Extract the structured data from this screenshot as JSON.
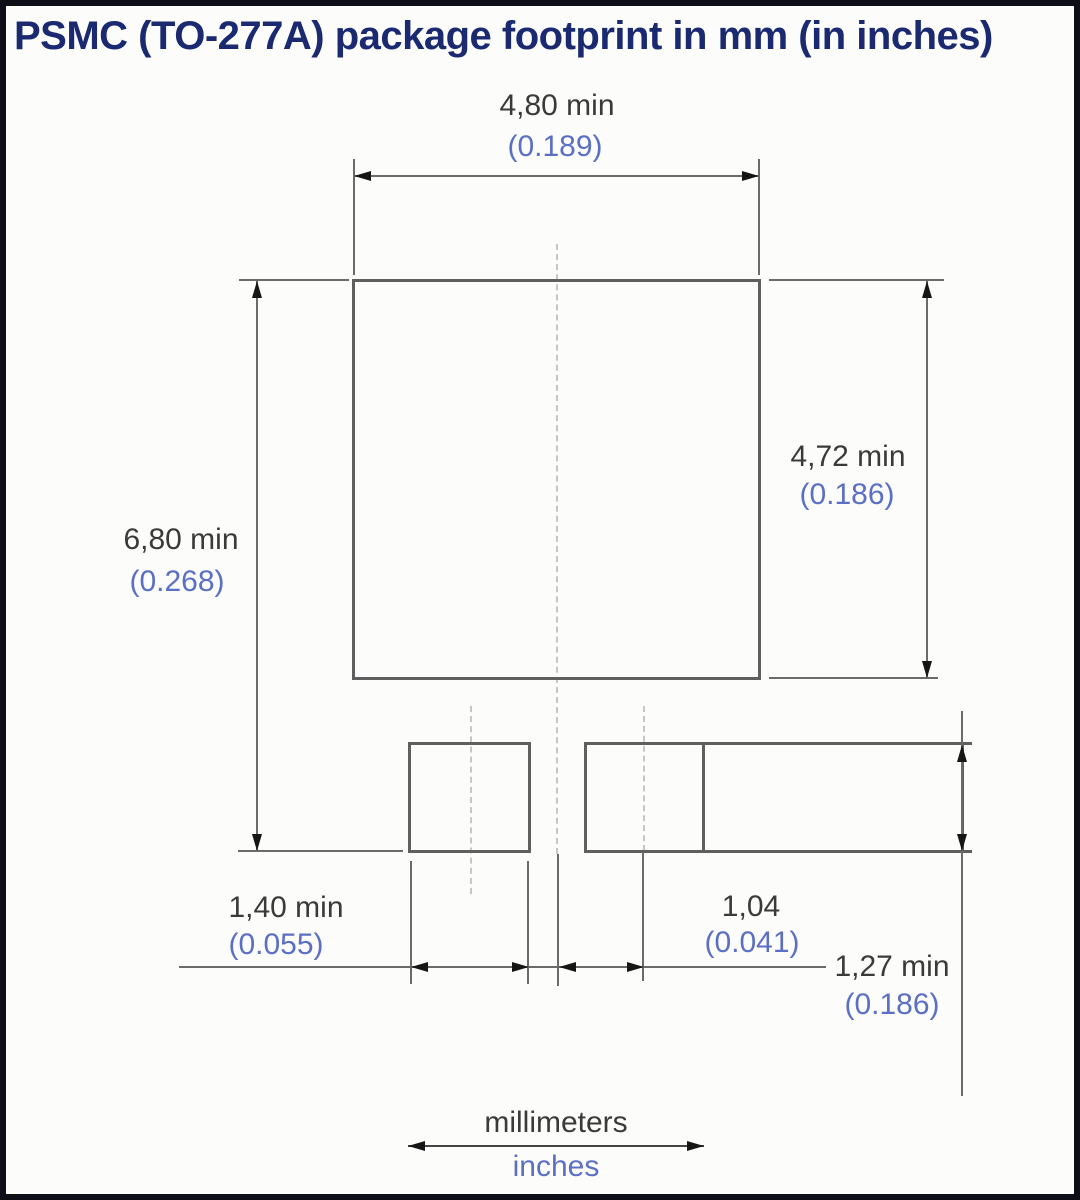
{
  "title": "PSMC (TO-277A) package footprint in mm (in inches)",
  "dimensions": {
    "body_width": {
      "mm": "4,80 min",
      "inches": "(0.189)"
    },
    "body_height": {
      "mm": "4,72 min",
      "inches": "(0.186)"
    },
    "overall_height": {
      "mm": "6,80 min",
      "inches": "(0.268)"
    },
    "small_pad_width": {
      "mm": "1,40 min",
      "inches": "(0.055)"
    },
    "pad_center_offset": {
      "mm": "1,04",
      "inches": "(0.041)"
    },
    "pad_height": {
      "mm": "1,27 min",
      "inches": "(0.186)"
    }
  },
  "legend": {
    "millimeters": "millimeters",
    "inches": "inches"
  },
  "colors": {
    "title_text": "#1b2a70",
    "mm_text": "#3a3a3a",
    "inch_text": "#5b6fc4",
    "outline": "#5f5f5f",
    "dimension_line": "#6b6b6b",
    "arrowhead": "#161616",
    "centerline": "#c6c6c6",
    "frame_border": "#0e0e16",
    "background": "#fcfcfa"
  }
}
